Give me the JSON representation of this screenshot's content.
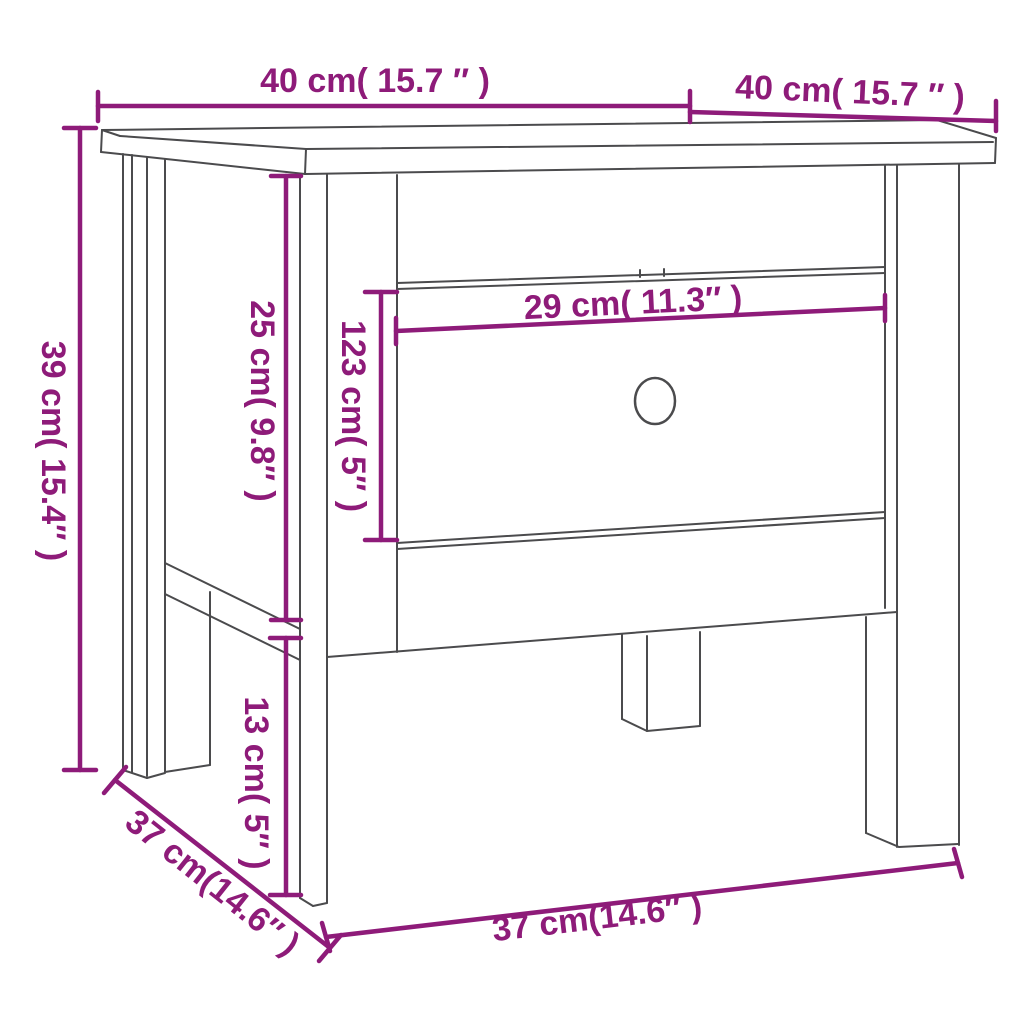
{
  "diagram": {
    "type": "furniture-dimension-diagram",
    "product": "side table with drawer",
    "background": "#ffffff",
    "line_color": "#4b4b4d",
    "accent_color": "#8e1b79",
    "measurements": [
      {
        "id": "top_width",
        "label": "40 cm( 15.7 ″ )",
        "cm": "40",
        "inch": "15.7",
        "location": "tabletop width (front top edge)"
      },
      {
        "id": "top_depth",
        "label": "40 cm( 15.7 ″ )",
        "cm": "40",
        "inch": "15.7",
        "location": "tabletop depth (right top edge)"
      },
      {
        "id": "overall_height",
        "label": "39 cm( 15.4″ )",
        "cm": "39",
        "inch": "15.4",
        "location": "overall height (left side)"
      },
      {
        "id": "apron_height",
        "label": "25 cm( 9.8″ )",
        "cm": "25",
        "inch": "9.8",
        "location": "tabletop underside to lower side rail"
      },
      {
        "id": "drawer_front_height",
        "label": "123 cm( 5″ )",
        "cm": "123",
        "inch": "5",
        "location": "drawer front height"
      },
      {
        "id": "drawer_front_width",
        "label": "29 cm( 11.3″ )",
        "cm": "29",
        "inch": "11.3",
        "location": "drawer front width"
      },
      {
        "id": "leg_clearance",
        "label": "13 cm( 5″ )",
        "cm": "13",
        "inch": "5",
        "location": "lower side rail to floor"
      },
      {
        "id": "base_depth",
        "label": "37 cm(14.6″ )",
        "cm": "37",
        "inch": "14.6",
        "location": "base depth (diagonal, left side)"
      },
      {
        "id": "base_width",
        "label": "37 cm(14.6″ )",
        "cm": "37",
        "inch": "14.6",
        "location": "base width (front bottom)"
      }
    ],
    "parts": {
      "knob": "round drawer knob"
    }
  }
}
